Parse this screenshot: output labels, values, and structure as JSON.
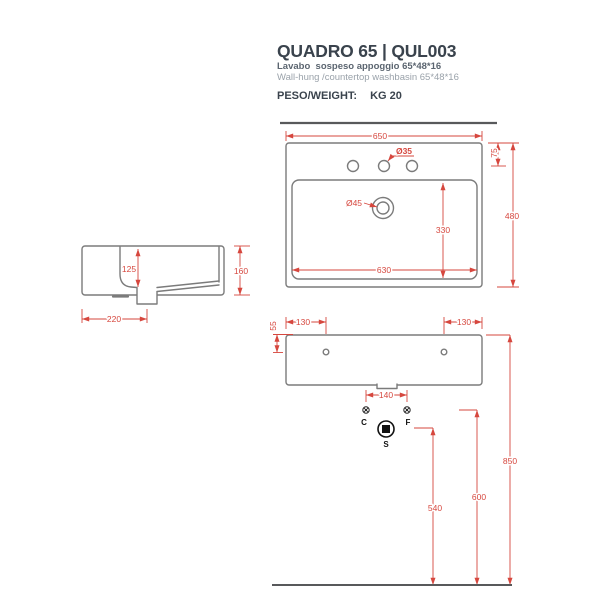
{
  "header": {
    "title": "QUADRO 65 | QUL003",
    "subtitle_it": "Lavabo  sospeso appoggio 65*48*16",
    "subtitle_en": "Wall-hung /countertop washbasin 65*48*16",
    "weight_label": "PESO/WEIGHT:",
    "weight_value": "KG 20"
  },
  "colors": {
    "dimension_red": "#d6473e",
    "outline_gray": "#7b7b7b",
    "wall_floor_gray": "#58595b",
    "title_dark": "#3a434d",
    "subtitle_mid": "#5b6570",
    "subtitle_light": "#9aa2aa"
  },
  "top_view": {
    "width": "650",
    "depth": "480",
    "faucet_offset": "75",
    "faucet_hole": "Ø35",
    "drain": "Ø45",
    "inner_width": "630",
    "inner_depth": "330"
  },
  "side_view": {
    "bowl_depth": "125",
    "height": "160",
    "drain_offset": "220"
  },
  "front_view": {
    "hole_inset_left": "130",
    "hole_inset_right": "130",
    "hole_drop": "55",
    "supply_spacing": "140",
    "hot": "C",
    "cold": "F",
    "drain": "S",
    "drain_height": "540",
    "supply_height": "600",
    "rim_height": "850"
  }
}
